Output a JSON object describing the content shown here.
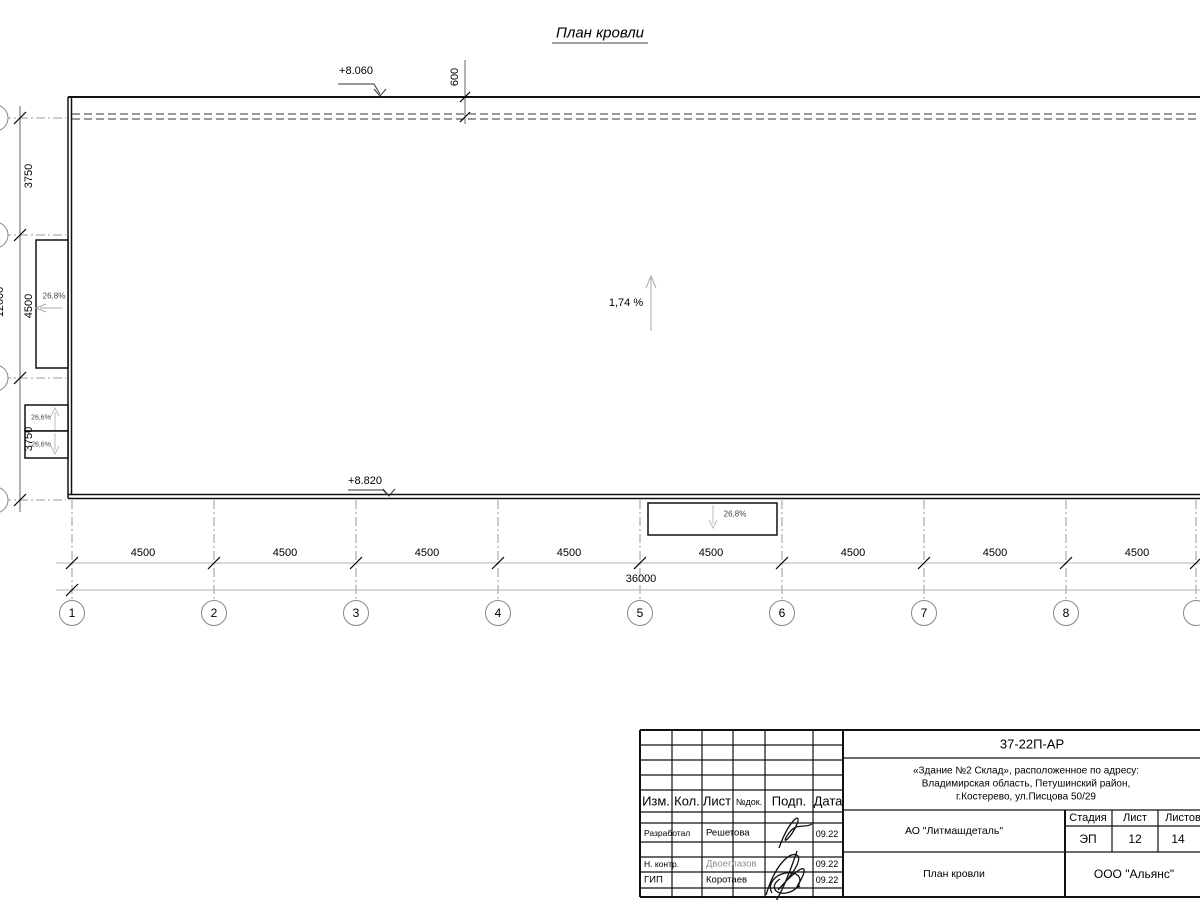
{
  "title": "План кровли",
  "annotations": {
    "elev_top": "+8.060",
    "elev_bottom": "+8.820",
    "offset_top": "600",
    "slope_main": "1,74 %",
    "slope_left": "26,8%",
    "slope_box_top": "26,6%",
    "slope_box_bottom": "26,6%",
    "slope_bottom": "26,8%"
  },
  "dims": {
    "left": [
      "3750",
      "4500",
      "3750"
    ],
    "left_total": "12000",
    "bottom": [
      "4500",
      "4500",
      "4500",
      "4500",
      "4500",
      "4500",
      "4500",
      "4500"
    ],
    "bottom_total": "36000"
  },
  "grid_labels": [
    "1",
    "2",
    "3",
    "4",
    "5",
    "6",
    "7",
    "8"
  ],
  "titleblock": {
    "doc_number": "37-22П-АР",
    "address": {
      "line1": "«Здание №2 Склад», расположенное по адресу:",
      "line2": "Владимирская область, Петушинский район,",
      "line3": "г.Костерево, ул.Писцова 50/29"
    },
    "columns": {
      "izm": "Изм.",
      "kol": "Кол.",
      "list": "Лист",
      "ndok": "№док.",
      "podp": "Подп.",
      "data": "Дата"
    },
    "rows": [
      {
        "role": "Разработал",
        "name": "Решетова",
        "date": "09.22"
      },
      {
        "role": "Н. контр.",
        "name": "Двоеглазов",
        "date": "09.22"
      },
      {
        "role": "ГИП",
        "name": "Коротаев",
        "date": "09.22"
      }
    ],
    "company": "АО \"Литмашдеталь\"",
    "stage_label": "Стадия",
    "sheet_label": "Лист",
    "sheets_label": "Листов",
    "stage": "ЭП",
    "sheet": "12",
    "sheets": "14",
    "sheet_title": "План кровли",
    "org": "ООО \"Альянс\""
  }
}
